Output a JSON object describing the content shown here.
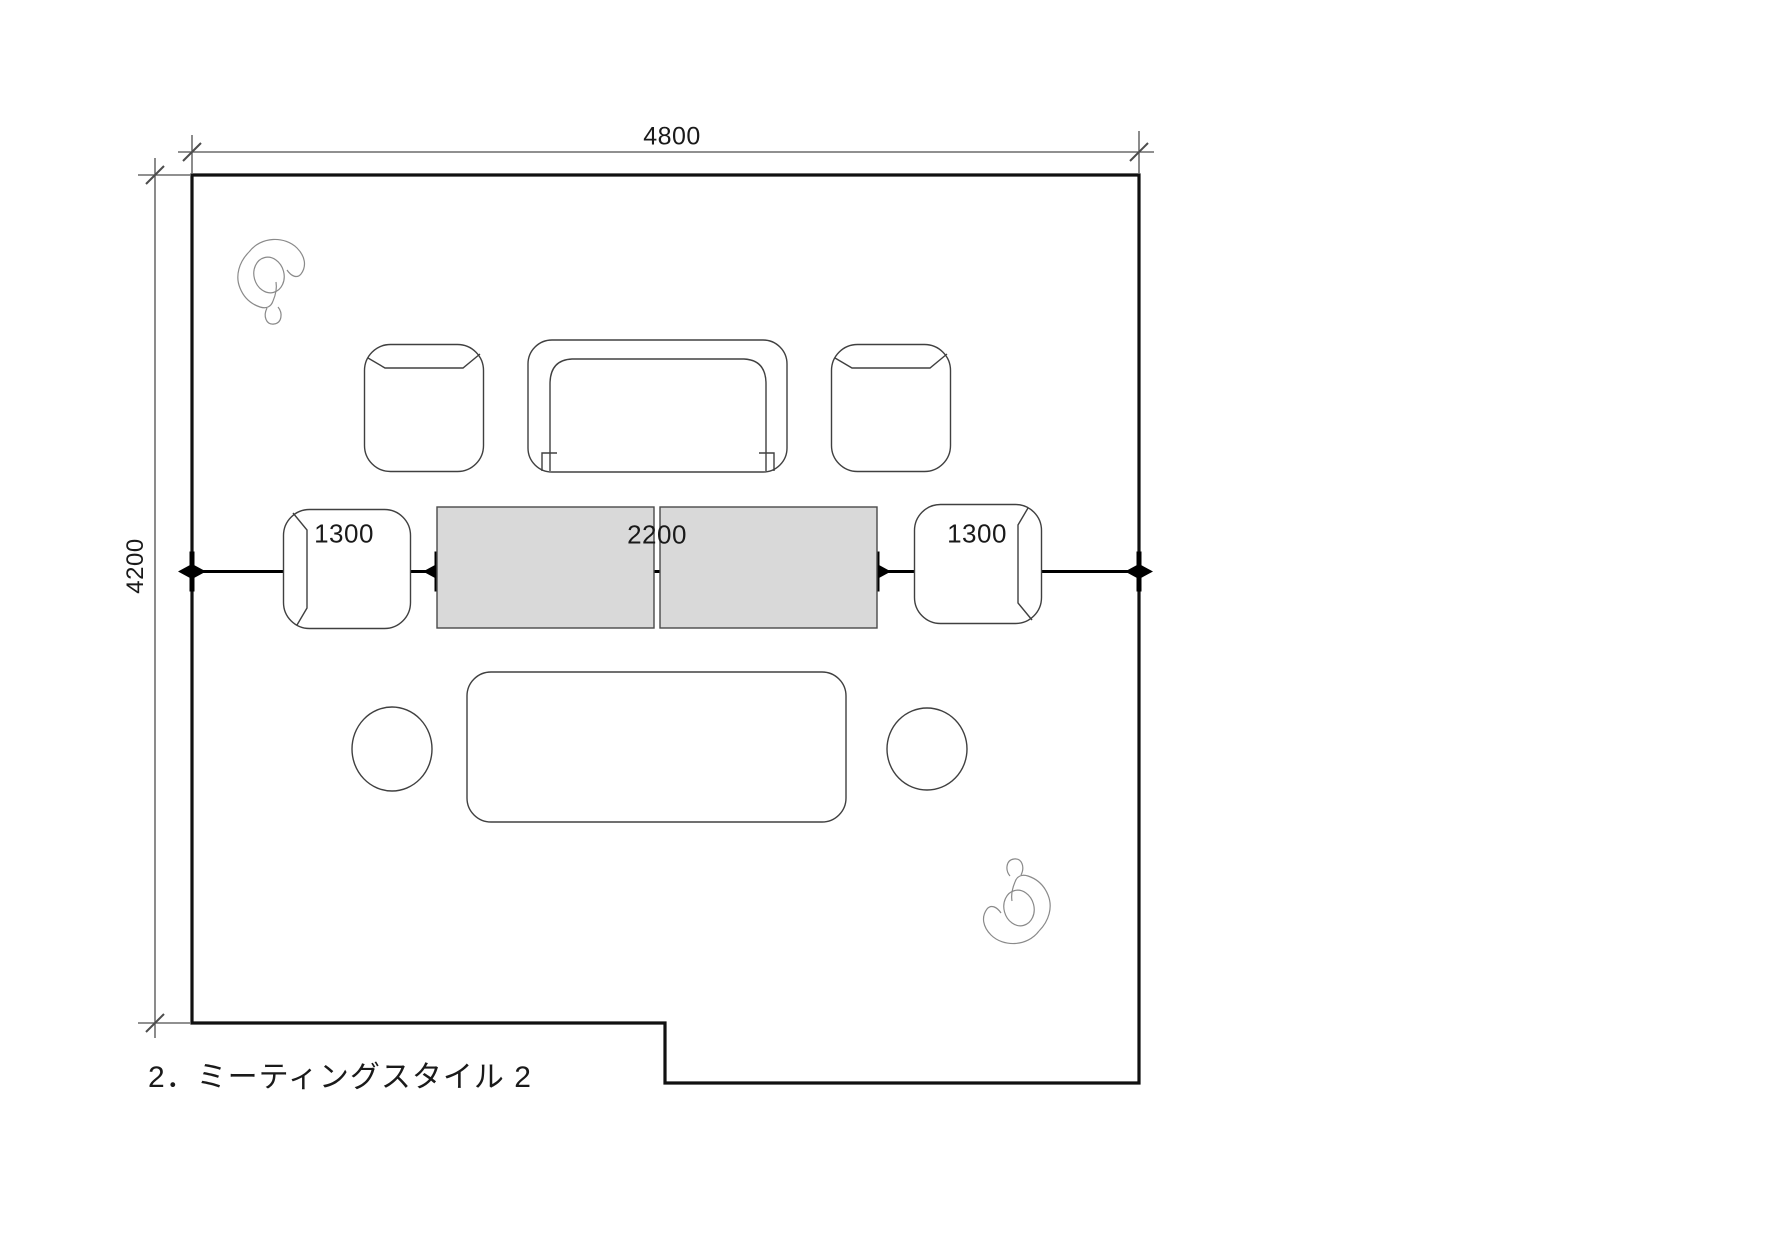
{
  "caption": {
    "text": "2．ミーティングスタイル 2"
  },
  "dimensions": {
    "top_width": "4800",
    "left_depth": "4200",
    "chain_left": "1300",
    "chain_center": "2200",
    "chain_right": "1300"
  },
  "room": {
    "shape": "rectangular room with notched bottom-right step",
    "furniture": [
      "armchair-top-left",
      "sofa-two-seat",
      "armchair-top-right",
      "armchair-middle-left",
      "meeting-table-left",
      "meeting-table-right",
      "armchair-middle-right",
      "low-table",
      "stool-left",
      "stool-right",
      "person-top-left",
      "person-bottom-right"
    ]
  },
  "colors": {
    "wall_line": "#111111",
    "furniture_line": "#404040",
    "dimension_thin_line": "#4d4d4d",
    "dimension_bold_line": "#000000",
    "table_fill": "#d9d9d9",
    "text": "#1a1a1a",
    "background": "#ffffff"
  }
}
